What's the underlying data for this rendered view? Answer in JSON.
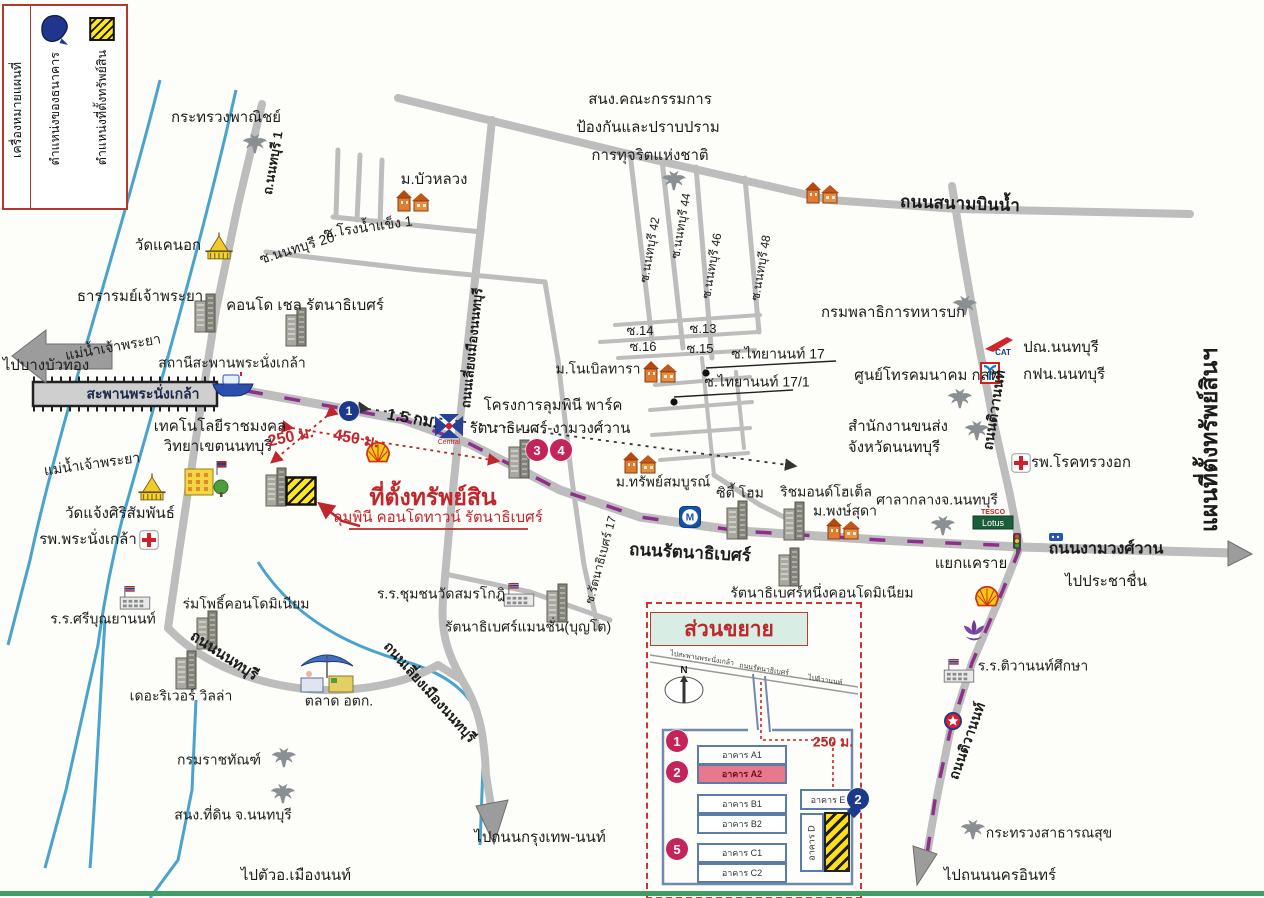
{
  "legend": {
    "title": "เครื่องหมายแผนที่",
    "items": [
      {
        "symbol": "bank-marker",
        "label": "ตำแหน่งของธนาคาร",
        "color": "#20368c"
      },
      {
        "symbol": "property-marker",
        "label": "ตำแหน่งที่ตั้งทรัพย์สิน",
        "color": "#ffe81a"
      }
    ]
  },
  "map": {
    "sheet_title": "แผนที่ตั้งทรัพย์สินฯ",
    "property": {
      "headline": "ที่ตั้งทรัพย์สิน",
      "name": "ลุมพินี คอนโดทาวน์ รัตนาธิเบศร์"
    },
    "inset": {
      "title": "ส่วนขยาย",
      "compass_label": "N",
      "distance": "250 ม.",
      "buildings": [
        {
          "label": "อาคาร A1",
          "x": 697,
          "y": 745,
          "w": 86,
          "h": 16,
          "style": "normal"
        },
        {
          "label": "อาคาร A2",
          "x": 697,
          "y": 764,
          "w": 86,
          "h": 16,
          "style": "highlight"
        },
        {
          "label": "อาคาร B1",
          "x": 697,
          "y": 794,
          "w": 86,
          "h": 16,
          "style": "normal"
        },
        {
          "label": "อาคาร B2",
          "x": 697,
          "y": 814,
          "w": 86,
          "h": 16,
          "style": "normal"
        },
        {
          "label": "อาคาร C1",
          "x": 697,
          "y": 843,
          "w": 86,
          "h": 16,
          "style": "normal"
        },
        {
          "label": "อาคาร C2",
          "x": 697,
          "y": 863,
          "w": 86,
          "h": 16,
          "style": "normal"
        },
        {
          "label": "อาคาร E",
          "x": 800,
          "y": 789,
          "w": 52,
          "h": 17,
          "style": "normal"
        },
        {
          "label": "อาคาร D",
          "x": 800,
          "y": 813,
          "w": 20,
          "h": 55,
          "style": "vertical"
        },
        {
          "label": "",
          "x": 824,
          "y": 812,
          "w": 22,
          "h": 56,
          "style": "hatch"
        }
      ]
    },
    "labels": [
      {
        "t": "กระทรวงพาณิชย์",
        "x": 226,
        "y": 118,
        "k": "place-label"
      },
      {
        "t": "ม.บัวหลวง",
        "x": 434,
        "y": 180,
        "k": "place-label"
      },
      {
        "t": "ซ.โรงน้ำแข็ง 1",
        "x": 368,
        "y": 227,
        "r": -8,
        "s": 14,
        "k": "soi-label"
      },
      {
        "t": "ซ.นนทบุรี 20",
        "x": 297,
        "y": 248,
        "r": -17,
        "s": 14,
        "k": "soi-label"
      },
      {
        "t": "วัดแคนอก",
        "x": 168,
        "y": 246,
        "k": "place-label"
      },
      {
        "t": "ธารารมย์เจ้าพระยา",
        "x": 140,
        "y": 297,
        "k": "place-label"
      },
      {
        "t": "แม่น้ำเจ้าพระยา",
        "x": 113,
        "y": 347,
        "r": -10,
        "s": 14,
        "k": "river-label"
      },
      {
        "t": "แม่น้ำเจ้าพระยา",
        "x": 92,
        "y": 464,
        "r": -8,
        "s": 14,
        "k": "river-label"
      },
      {
        "t": "ไปบางบัวทอง",
        "x": 46,
        "y": 366,
        "k": "direction-label"
      },
      {
        "t": "คอนโด เชล รัตนาธิเบศร์",
        "x": 305,
        "y": 306,
        "k": "place-label"
      },
      {
        "t": "สถานีสะพานพระนั่งเกล้า",
        "x": 232,
        "y": 363,
        "s": 14,
        "k": "place-label"
      },
      {
        "t": "สะพานพระนั่งเกล้า",
        "x": 143,
        "y": 394,
        "s": 14,
        "b": 1,
        "c": "#1b2a4a",
        "k": "bridge-label"
      },
      {
        "t": "ถ.นนทบุรี 1",
        "x": 273,
        "y": 163,
        "r": -80,
        "s": 13,
        "b": 1,
        "k": "road-label"
      },
      {
        "t": "สนง.คณะกรรมการ",
        "x": 650,
        "y": 100,
        "k": "place-label"
      },
      {
        "t": "ป้องกันและปราบปราม",
        "x": 648,
        "y": 128,
        "k": "place-label"
      },
      {
        "t": "การทุจริตแห่งชาติ",
        "x": 650,
        "y": 156,
        "k": "place-label"
      },
      {
        "t": "ถนนสนามบินน้ำ",
        "x": 960,
        "y": 204,
        "r": 2,
        "s": 17,
        "b": 1,
        "k": "road-label"
      },
      {
        "t": "ซ.นนทบุรี 42",
        "x": 650,
        "y": 250,
        "r": -80,
        "s": 12,
        "k": "soi-label"
      },
      {
        "t": "ซ.นนทบุรี 44",
        "x": 681,
        "y": 226,
        "r": -80,
        "s": 12,
        "k": "soi-label"
      },
      {
        "t": "ซ.นนทบุรี 46",
        "x": 712,
        "y": 266,
        "r": -80,
        "s": 12,
        "k": "soi-label"
      },
      {
        "t": "ซ.นนทบุรี 48",
        "x": 761,
        "y": 268,
        "r": -80,
        "s": 12,
        "k": "soi-label"
      },
      {
        "t": "กรมพลาธิการทหารบก",
        "x": 893,
        "y": 313,
        "k": "place-label"
      },
      {
        "t": "ซ.14",
        "x": 640,
        "y": 331,
        "s": 13,
        "k": "soi-label"
      },
      {
        "t": "ซ.13",
        "x": 703,
        "y": 329,
        "s": 13,
        "k": "soi-label"
      },
      {
        "t": "ซ.16",
        "x": 643,
        "y": 347,
        "s": 13,
        "k": "soi-label"
      },
      {
        "t": "ซ.15",
        "x": 700,
        "y": 349,
        "s": 13,
        "k": "soi-label"
      },
      {
        "t": "ซ.ไทยานนท์ 17",
        "x": 778,
        "y": 354,
        "s": 14,
        "k": "soi-label"
      },
      {
        "t": "ซ.ไทยานนท์ 17/1",
        "x": 757,
        "y": 382,
        "s": 14,
        "k": "soi-label"
      },
      {
        "t": "ม.โนเบิลทารา",
        "x": 598,
        "y": 369,
        "s": 14,
        "k": "place-label"
      },
      {
        "t": "ศูนย์โทรคมนาคม กสท",
        "x": 927,
        "y": 376,
        "k": "place-label"
      },
      {
        "t": "ปณ.นนทบุรี",
        "x": 1061,
        "y": 348,
        "k": "place-label"
      },
      {
        "t": "กฟน.นนทบุรี",
        "x": 1064,
        "y": 375,
        "k": "place-label"
      },
      {
        "t": "สำนักงานขนส่ง",
        "x": 898,
        "y": 427,
        "k": "place-label"
      },
      {
        "t": "จังหวัดนนทบุรี",
        "x": 894,
        "y": 448,
        "k": "place-label"
      },
      {
        "t": "รพ.โรคทรวงอก",
        "x": 1081,
        "y": 463,
        "k": "place-label"
      },
      {
        "t": "ถนนติวานนท์",
        "x": 994,
        "y": 410,
        "r": -81,
        "s": 14,
        "b": 1,
        "k": "road-label"
      },
      {
        "t": "ถนนติวานนท์",
        "x": 967,
        "y": 741,
        "r": -70,
        "s": 14,
        "b": 1,
        "k": "road-label"
      },
      {
        "t": "แผนที่ตั้งทรัพย์สินฯ",
        "x": 1209,
        "y": 440,
        "r": -90,
        "s": 23,
        "b": 1,
        "k": "map-sheet-title"
      },
      {
        "t": "โครงการลุมพินี พาร์ค",
        "x": 553,
        "y": 406,
        "k": "place-label"
      },
      {
        "t": "รัตนาธิเบศร์-งามวงศ์วาน",
        "x": 550,
        "y": 429,
        "k": "place-label"
      },
      {
        "t": "เทคโนโลยีราชมงคล",
        "x": 220,
        "y": 427,
        "k": "place-label"
      },
      {
        "t": "วิทยาเขตนนทบุรี",
        "x": 218,
        "y": 447,
        "k": "place-label"
      },
      {
        "t": "วัดแจ้งศิริสัมพันธ์",
        "x": 120,
        "y": 514,
        "k": "place-label"
      },
      {
        "t": "รพ.พระนั่งเกล้า",
        "x": 88,
        "y": 540,
        "k": "place-label"
      },
      {
        "t": "250 ม.",
        "x": 291,
        "y": 438,
        "r": -12,
        "s": 16,
        "b": 1,
        "c": "#c0272d",
        "k": "distance-label"
      },
      {
        "t": "450 ม.",
        "x": 356,
        "y": 440,
        "r": 10,
        "s": 16,
        "b": 1,
        "c": "#c0272d",
        "k": "distance-label"
      },
      {
        "t": "1.5 กม.",
        "x": 412,
        "y": 420,
        "r": 10,
        "s": 16,
        "b": 1,
        "k": "distance-label"
      },
      {
        "t": "ที่ตั้งทรัพย์สิน",
        "x": 433,
        "y": 497,
        "s": 23,
        "b": 1,
        "c": "#c0272d",
        "k": "property-location-headline"
      },
      {
        "t": "ลุมพินี คอนโดทาวน์ รัตนาธิเบศร์",
        "x": 438,
        "y": 518,
        "s": 15,
        "c": "#c0272d",
        "k": "property-name"
      },
      {
        "t": "ม.ทรัพย์สมบูรณ์",
        "x": 663,
        "y": 482,
        "s": 14,
        "k": "place-label"
      },
      {
        "t": "ซิตี้ โฮม",
        "x": 740,
        "y": 493,
        "s": 14,
        "k": "place-label"
      },
      {
        "t": "ริชมอนด์โฮเต็ล",
        "x": 826,
        "y": 492,
        "s": 14,
        "k": "place-label"
      },
      {
        "t": "ม.พงษ์สุดา",
        "x": 845,
        "y": 511,
        "s": 14,
        "k": "place-label"
      },
      {
        "t": "ศาลากลางจ.นนทบุรี",
        "x": 937,
        "y": 500,
        "s": 14,
        "k": "place-label"
      },
      {
        "t": "ถนนรัตนาธิเบศร์",
        "x": 690,
        "y": 553,
        "r": 3,
        "s": 17,
        "b": 1,
        "k": "road-label"
      },
      {
        "t": "แยกแคราย",
        "x": 971,
        "y": 564,
        "s": 15,
        "k": "place-label"
      },
      {
        "t": "ถนนงามวงศ์วาน",
        "x": 1106,
        "y": 550,
        "s": 16,
        "b": 1,
        "k": "road-label"
      },
      {
        "t": "ไปประชาชื่น",
        "x": 1106,
        "y": 582,
        "k": "direction-label"
      },
      {
        "t": "รัตนาธิเบศร์หนึ่งคอนโดมิเนียม",
        "x": 822,
        "y": 593,
        "s": 14,
        "k": "place-label"
      },
      {
        "t": "ร.ร.ชุมชนวัดสมรโกฎิ",
        "x": 441,
        "y": 594,
        "s": 14,
        "k": "place-label"
      },
      {
        "t": "รัตนาธิเบศร์แมนชั่น(บุญโต)",
        "x": 528,
        "y": 627,
        "s": 14,
        "k": "place-label"
      },
      {
        "t": "ซ.รัตนาธิเบศร์ 17",
        "x": 601,
        "y": 560,
        "r": -75,
        "s": 12,
        "k": "soi-label"
      },
      {
        "t": "ถนนเลี่ยงเมืองนนทบุรี",
        "x": 472,
        "y": 348,
        "r": -84,
        "s": 13,
        "b": 1,
        "k": "road-label"
      },
      {
        "t": "ร.ร.ศรีบุณยานนท์",
        "x": 103,
        "y": 619,
        "s": 14,
        "k": "place-label"
      },
      {
        "t": "ร่มโพธิ์คอนโดมิเนียม",
        "x": 246,
        "y": 604,
        "s": 14,
        "k": "place-label"
      },
      {
        "t": "เดอะริเวอร์ วิลล่า",
        "x": 181,
        "y": 696,
        "s": 14,
        "k": "place-label"
      },
      {
        "t": "ถนนนนทบุรี",
        "x": 224,
        "y": 656,
        "r": 33,
        "s": 15,
        "b": 1,
        "k": "road-label"
      },
      {
        "t": "ตลาด อตก.",
        "x": 339,
        "y": 701,
        "s": 14,
        "k": "place-label"
      },
      {
        "t": "ถนนเลี่ยงเมืองนนทบุรี",
        "x": 430,
        "y": 692,
        "r": 48,
        "s": 14,
        "b": 1,
        "k": "road-label"
      },
      {
        "t": "กรมราชทัณฑ์",
        "x": 219,
        "y": 760,
        "s": 14,
        "k": "place-label"
      },
      {
        "t": "สนง.ที่ดิน จ.นนทบุรี",
        "x": 233,
        "y": 815,
        "s": 14,
        "k": "place-label"
      },
      {
        "t": "ไปตัวอ.เมืองนนท์",
        "x": 296,
        "y": 876,
        "k": "direction-label"
      },
      {
        "t": "ไปถนนกรุงเทพ-นนท์",
        "x": 540,
        "y": 838,
        "k": "direction-label"
      },
      {
        "t": "กระทรวงสาธารณสุข",
        "x": 1049,
        "y": 833,
        "s": 14,
        "k": "place-label"
      },
      {
        "t": "ไปถนนนครอินทร์",
        "x": 1000,
        "y": 876,
        "k": "direction-label"
      },
      {
        "t": "ร.ร.ติวานนท์ศึกษา",
        "x": 1033,
        "y": 666,
        "s": 14,
        "k": "place-label"
      },
      {
        "t": "N",
        "x": 684,
        "y": 671,
        "s": 10,
        "b": 1,
        "k": "compass-label"
      },
      {
        "t": "ไปสะพานพระนั่งเกล้า",
        "x": 702,
        "y": 659,
        "r": 9,
        "s": 7,
        "c": "#444",
        "k": "direction-label"
      },
      {
        "t": "ถนนรัตนาธิเบศร์",
        "x": 764,
        "y": 670,
        "r": 9,
        "s": 7,
        "c": "#444",
        "k": "road-label"
      },
      {
        "t": "ไปติวานนท์",
        "x": 825,
        "y": 681,
        "r": 9,
        "s": 7,
        "c": "#444",
        "k": "direction-label"
      },
      {
        "t": "250 ม.",
        "x": 833,
        "y": 742,
        "s": 14,
        "b": 1,
        "c": "#c0272d",
        "k": "distance-label"
      }
    ],
    "icons": [
      {
        "type": "garuda",
        "x": 253,
        "y": 144
      },
      {
        "type": "garuda",
        "x": 672,
        "y": 181
      },
      {
        "type": "garuda",
        "x": 963,
        "y": 306
      },
      {
        "type": "garuda",
        "x": 958,
        "y": 399
      },
      {
        "type": "garuda",
        "x": 975,
        "y": 431
      },
      {
        "type": "garuda",
        "x": 941,
        "y": 526
      },
      {
        "type": "garuda",
        "x": 282,
        "y": 758
      },
      {
        "type": "garuda",
        "x": 281,
        "y": 794
      },
      {
        "type": "garuda",
        "x": 971,
        "y": 830
      },
      {
        "type": "temple",
        "x": 219,
        "y": 247
      },
      {
        "type": "temple",
        "x": 152,
        "y": 488
      },
      {
        "type": "redcross",
        "x": 1021,
        "y": 463
      },
      {
        "type": "redcross",
        "x": 149,
        "y": 540
      },
      {
        "type": "school",
        "x": 135,
        "y": 598
      },
      {
        "type": "school",
        "x": 519,
        "y": 595
      },
      {
        "type": "school",
        "x": 959,
        "y": 671
      },
      {
        "type": "graybuilding",
        "x": 205,
        "y": 313
      },
      {
        "type": "graybuilding",
        "x": 296,
        "y": 327
      },
      {
        "type": "graybuilding",
        "x": 207,
        "y": 630
      },
      {
        "type": "graybuilding",
        "x": 186,
        "y": 670
      },
      {
        "type": "graybuilding",
        "x": 737,
        "y": 520
      },
      {
        "type": "graybuilding",
        "x": 794,
        "y": 521
      },
      {
        "type": "graybuilding",
        "x": 789,
        "y": 567
      },
      {
        "type": "graybuilding",
        "x": 557,
        "y": 603
      },
      {
        "type": "graybuilding",
        "x": 519,
        "y": 459
      },
      {
        "type": "graybuilding",
        "x": 276,
        "y": 487
      },
      {
        "type": "orangebuilding",
        "x": 413,
        "y": 201
      },
      {
        "type": "orangebuilding",
        "x": 822,
        "y": 193
      },
      {
        "type": "orangebuilding",
        "x": 660,
        "y": 372
      },
      {
        "type": "orangebuilding",
        "x": 640,
        "y": 463
      },
      {
        "type": "orangebuilding",
        "x": 843,
        "y": 529
      },
      {
        "type": "yellowbuilding",
        "x": 207,
        "y": 478
      },
      {
        "type": "market",
        "x": 327,
        "y": 673
      },
      {
        "type": "boat",
        "x": 233,
        "y": 384
      },
      {
        "type": "shell",
        "x": 378,
        "y": 453
      },
      {
        "type": "shell",
        "x": 987,
        "y": 597
      },
      {
        "type": "central",
        "x": 449,
        "y": 430
      },
      {
        "type": "cat",
        "x": 999,
        "y": 346
      },
      {
        "type": "mea",
        "x": 990,
        "y": 374
      },
      {
        "type": "mrt",
        "x": 690,
        "y": 517
      },
      {
        "type": "tescolotus",
        "x": 993,
        "y": 519
      },
      {
        "type": "caltex",
        "x": 953,
        "y": 721
      },
      {
        "type": "purpleflower",
        "x": 974,
        "y": 632
      },
      {
        "type": "trafficlight",
        "x": 1017,
        "y": 544
      },
      {
        "type": "propertysq",
        "x": 301,
        "y": 491
      },
      {
        "type": "dot",
        "x": 706,
        "y": 368
      },
      {
        "type": "dot",
        "x": 674,
        "y": 397
      },
      {
        "type": "pdot",
        "x": 707,
        "y": 753
      },
      {
        "type": "pdot",
        "x": 707,
        "y": 850
      },
      {
        "type": "bluemark",
        "x": 1056,
        "y": 532
      }
    ],
    "markers": [
      {
        "n": "1",
        "style": "blue",
        "x": 349,
        "y": 411
      },
      {
        "n": "3",
        "style": "pink",
        "x": 537,
        "y": 450
      },
      {
        "n": "4",
        "style": "pink",
        "x": 561,
        "y": 450
      },
      {
        "n": "1",
        "style": "pink",
        "x": 677,
        "y": 741
      },
      {
        "n": "2",
        "style": "pink",
        "x": 677,
        "y": 772
      },
      {
        "n": "5",
        "style": "pink",
        "x": 677,
        "y": 849
      },
      {
        "n": "2",
        "style": "bluepin",
        "x": 858,
        "y": 799
      }
    ]
  }
}
